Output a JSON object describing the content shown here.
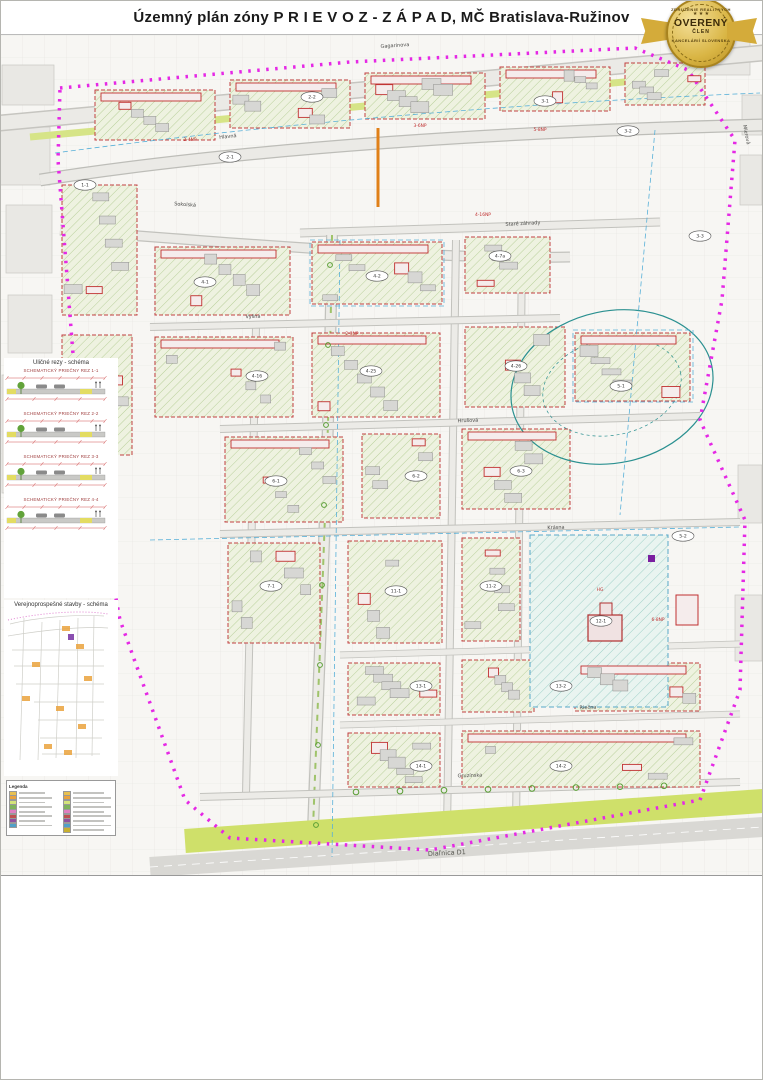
{
  "title": "Územný plán zóny P R I E V O Z - Z Á P A D, MČ Bratislava-Ružinov",
  "badge": {
    "arc_top": "ZDRUŽENIE REALITNÝCH",
    "stars": "★ ★ ★",
    "main": "OVERENÝ",
    "sub": "ČLEN",
    "arc_bottom": "KANCELÁRIÍ SLOVENSKA",
    "gold": "#d9b544"
  },
  "map": {
    "boundary_color": "#e528e5",
    "streets": [
      {
        "label": "Gagarinova",
        "x": 395,
        "y": 12,
        "r": -4
      },
      {
        "label": "Hlavná",
        "x": 228,
        "y": 103,
        "r": -6
      },
      {
        "label": "Mierová",
        "x": 745,
        "y": 100,
        "r": 78
      },
      {
        "label": "Sokolská",
        "x": 185,
        "y": 171,
        "r": 4
      },
      {
        "label": "Staré záhrady",
        "x": 523,
        "y": 190,
        "r": -3
      },
      {
        "label": "Vyšná",
        "x": 253,
        "y": 283,
        "r": -2
      },
      {
        "label": "Hrušová",
        "x": 468,
        "y": 387,
        "r": -2
      },
      {
        "label": "Krásna",
        "x": 556,
        "y": 494,
        "r": -2
      },
      {
        "label": "Riečna",
        "x": 588,
        "y": 674,
        "r": -2
      },
      {
        "label": "Gruzínska",
        "x": 470,
        "y": 742,
        "r": -2
      }
    ],
    "highway_label": {
      "label": "Diaľnica D1",
      "x": 447,
      "y": 820,
      "r": -3
    },
    "ovals": [
      {
        "c": "1-1",
        "x": 85,
        "y": 150
      },
      {
        "c": "2-1",
        "x": 230,
        "y": 122
      },
      {
        "c": "2-2",
        "x": 312,
        "y": 62
      },
      {
        "c": "3-1",
        "x": 545,
        "y": 66
      },
      {
        "c": "3-2",
        "x": 628,
        "y": 96
      },
      {
        "c": "4-1",
        "x": 205,
        "y": 247
      },
      {
        "c": "4-2",
        "x": 377,
        "y": 241
      },
      {
        "c": "4-7a",
        "x": 500,
        "y": 221
      },
      {
        "c": "4-16",
        "x": 257,
        "y": 341
      },
      {
        "c": "4-25",
        "x": 371,
        "y": 336
      },
      {
        "c": "4-26",
        "x": 516,
        "y": 331
      },
      {
        "c": "5-1",
        "x": 621,
        "y": 351
      },
      {
        "c": "6-1",
        "x": 276,
        "y": 446
      },
      {
        "c": "6-2",
        "x": 416,
        "y": 441
      },
      {
        "c": "6-3",
        "x": 521,
        "y": 436
      },
      {
        "c": "7-1",
        "x": 271,
        "y": 551
      },
      {
        "c": "11-1",
        "x": 396,
        "y": 556
      },
      {
        "c": "11-2",
        "x": 491,
        "y": 551
      },
      {
        "c": "12-1",
        "x": 601,
        "y": 586
      },
      {
        "c": "13-1",
        "x": 421,
        "y": 651
      },
      {
        "c": "13-2",
        "x": 561,
        "y": 651
      },
      {
        "c": "14-1",
        "x": 421,
        "y": 731
      },
      {
        "c": "14-2",
        "x": 561,
        "y": 731
      },
      {
        "c": "5-2",
        "x": 683,
        "y": 501
      },
      {
        "c": "3-3",
        "x": 700,
        "y": 201
      }
    ],
    "bldg_labels": [
      {
        "t": "2-4NP",
        "x": 190,
        "y": 106
      },
      {
        "t": "3-6NP",
        "x": 420,
        "y": 92
      },
      {
        "t": "4-16NP",
        "x": 483,
        "y": 181
      },
      {
        "t": "5-8NP",
        "x": 540,
        "y": 96
      },
      {
        "t": "2-3NP",
        "x": 352,
        "y": 300
      },
      {
        "t": "HG",
        "x": 600,
        "y": 556
      },
      {
        "t": "6-8NP",
        "x": 658,
        "y": 586
      }
    ]
  },
  "left_panel": {
    "sections_title": "Uličné rezy - schéma",
    "sections": [
      "SCHEMATICKÝ PRIEČNY REZ 1-1",
      "SCHEMATICKÝ PRIEČNY REZ 2-2",
      "SCHEMATICKÝ PRIEČNY REZ 3-3",
      "SCHEMATICKÝ PRIEČNY REZ 4-4"
    ],
    "vps_title": "Verejnoprospešné stavby - schéma",
    "mini_legend_title": "Legenda",
    "mini_legend_chips": [
      "#e8c050",
      "#eaa23c",
      "#d4e47a",
      "#7fb35c",
      "#e07fc0",
      "#c05050",
      "#9050a0",
      "#50a0c8",
      "#e8c050",
      "#eaa23c",
      "#d4e47a",
      "#7fb35c",
      "#e07fc0",
      "#c05050",
      "#9050a0",
      "#50a0c8",
      "#c8b030"
    ]
  },
  "legend": {
    "heading": "Legenda:",
    "col1": [
      {
        "type": "boundary",
        "label": "hranica riešeného územia"
      },
      {
        "type": "thin",
        "label": "katastrálna mapa"
      },
      {
        "type": "grayfill",
        "label": "budovy existujúce"
      },
      {
        "type": "redbld",
        "label": "budovy navrhované"
      },
      {
        "type": "grayx",
        "label": "existujúce budovy v nesúlade s ÚPN BA"
      },
      {
        "type": "dashout",
        "label": "obrys podzemných častí budov"
      },
      {
        "type": "fence",
        "label": "oplotenie areálov"
      },
      {
        "type": "kota",
        "label": "výšková kóta m n. m. Bpv",
        "chip_text": "137,6"
      },
      {
        "type": "reddash",
        "label": "podzemné časti hromadných garáží navrhované"
      },
      {
        "type": "bluedash",
        "label": "hranica urbanistického sektora"
      },
      {
        "type": "reddash2",
        "label": "hranica stavebného bloku"
      },
      {
        "type": "rail",
        "label": "železničná trať"
      },
      {
        "type": "hwy",
        "label": "diaľnica D1"
      },
      {
        "type": "roadex",
        "label": "miestne cesty existujúce"
      },
      {
        "type": "roadnew",
        "label": "miestne cesty - návrh"
      }
    ],
    "col2_header1": "Ochranné pásma a pamiatková ochrana",
    "col2a": [
      {
        "type": "opdash",
        "label": "OP pohrebiska"
      },
      {
        "type": "opdash2",
        "label": "OP dráhy"
      },
      {
        "type": "opdash3",
        "label": "OP leteckej infraštruktúry"
      },
      {
        "type": "bluetext",
        "chip_text": "150,0",
        "label": "max. povolená výška objektu"
      },
      {
        "type": "greendash",
        "label": "historické parky (NKP)"
      },
      {
        "type": "purplesq",
        "label": "národná kultúrna pamiatka (NKP)"
      },
      {
        "type": "circle",
        "label": "pamätihodnosť MČ"
      }
    ],
    "col2_header2": "Regulácia využitia zastavateľných plôch",
    "col2b": [
      {
        "type": "redline",
        "label": "uličná čiara"
      },
      {
        "type": "darkline",
        "label": "stavebná čiara"
      },
      {
        "type": "pinkdot",
        "label": "aktívny parter"
      },
      {
        "type": "bluedashline",
        "label": "zadná stavebná čiara"
      },
      {
        "type": "bluetext",
        "chip_text": "4NP",
        "label": "maximálna podlažnosť"
      },
      {
        "type": "redtext",
        "chip_text": "x %",
        "label": "parametrický údaj"
      },
      {
        "type": "redtextit",
        "chip_text": "(x %)",
        "label": "parametrický údaj - smerný"
      }
    ],
    "col3_header": "Regulačné tabuľky",
    "col3_groups": [
      {
        "cells": [
          "1-1",
          "980"
        ],
        "labels": [
          "označenie stavebného bloku",
          "funkčné využitie"
        ]
      },
      {
        "cells": [
          "1-1",
          "980",
          "70:30"
        ],
        "labels": [
          "označenie stavebného bloku",
          "funkčné využitie",
          "parametrický pomer OVmin : BTVmax"
        ]
      },
      {
        "cells": [
          "1-1",
          "980",
          "4 NP"
        ],
        "labels": [
          "ozn. stavebného bloku",
          "funkčné využitie",
          "maximálna podlažnosť"
        ]
      },
      {
        "cells": [
          "1-4",
          "980",
          "70:30",
          "2 000",
          "5 800",
          "0,2"
        ],
        "labels": [
          "označenie stavebného bloku",
          "funkčné využitie",
          "parametrický pomer OVmin : BTVmax",
          "maximálna zastavaná plocha ZPmax",
          "maximálna hrubá podl. plocha NPPmax",
          "minimálny koeficient zelene KZmin"
        ]
      }
    ],
    "rd_title": "Regulácia max. zastavanej plochy pre RD",
    "rd_headers": [
      "Veľkosť pozemku (m²)",
      "Max. zastavaná plocha rodinného domu vr. garáže (m²)"
    ],
    "rd_rows": [
      [
        "do 400",
        "120"
      ],
      [
        "401 - 600",
        "150"
      ],
      [
        "601 - 800",
        "180"
      ],
      [
        "nad 800",
        "240"
      ]
    ],
    "col4_header": "Regulácia využitia nezastavateľných plôch",
    "col4_sub": "funkčné využitie",
    "col4": [
      {
        "chip": "#e6e0b0",
        "label": "plochy námestí"
      },
      {
        "chip": "#d8d8d4",
        "label": "verejné priestory s prevahou dopravnej funkcie"
      },
      {
        "chip": "#e0d8c0",
        "label": "verejné priestranstvá s dominanciou pešieho pohybu"
      },
      {
        "chip": "#cfe3b0",
        "label": "vyhradená zeleň areálov"
      },
      {
        "chip": "#bcd98e",
        "label": "zeleň parkov"
      },
      {
        "chip": "#c8e0c8",
        "label": "zeleň cintorínov"
      },
      {
        "chip": "#a8cf88",
        "label": "zeleň verejná"
      },
      {
        "chip": "#dceab8",
        "label": "zeleň záhrad"
      },
      {
        "chip": "#98c070",
        "label": "ochranná a izolačná zeleň"
      },
      {
        "chip": "#ffffff",
        "label": "dosadba uličných stromoradí"
      }
    ],
    "col4_param_cells": [
      "70",
      "30"
    ],
    "col4_param": "parametrický pomer spevnených a nespevnených plôch",
    "col4_note": "Pozn.:"
  },
  "reg_table": {
    "title": "Regulačné zásady vo vybraných stavebných blokoch",
    "headers": [
      "ÚZ profil ÚPN-BA",
      "FV profil ÚPN-BA",
      "označ. stav. bloku",
      "plocha ÚB (m²)",
      "kód funkč. využitia FV",
      "max. podlažnosť NP+ust.",
      "zastav. plocha (m²) ZPmax",
      "hrubá podl. plocha (m²) NPPmax",
      "koeficient zelene KZmin",
      "OVmax %",
      "BTVmax %"
    ],
    "rows": [
      [
        "01/2",
        "201",
        "3",
        "2 561",
        "OV",
        "5+0",
        "510",
        "1 600",
        "0,1",
        "100",
        "0"
      ],
      [
        "01/1",
        "201",
        "1-2a",
        "8 234",
        "OV",
        "8+0",
        "1 800",
        "9 200",
        "0,1",
        "100",
        "0"
      ],
      [
        "01/1",
        "201",
        "1-2b",
        "12 595",
        "OV",
        "5+0",
        "1 050",
        "10 400",
        "0,2",
        "100",
        "0"
      ],
      [
        "01/1",
        "201",
        "1-3*",
        "18 878",
        "OV",
        "11+0",
        "2 800",
        "22 600",
        "0,2",
        "100",
        "0"
      ],
      [
        "01/2",
        "201",
        "1-4",
        "5 828",
        "OV",
        "3+1",
        "2 000",
        "5 800",
        "0,2",
        "100",
        "20"
      ]
    ],
    "footnote": "1-3* - rezervovaná HPP pre realizáciu: min. 1 200 PM a 4 000 m² HPP, 1 200 PM a 6 000 m² HPP"
  },
  "sectors": {
    "title": "Urbanistické sektory a stavebné bloky - schéma",
    "numbers": [
      {
        "n": "1",
        "x": 68,
        "y": 16
      },
      {
        "n": "2",
        "x": 128,
        "y": 128
      },
      {
        "n": "3",
        "x": 152,
        "y": 100
      },
      {
        "n": "4",
        "x": 78,
        "y": 40
      },
      {
        "n": "5",
        "x": 22,
        "y": 33
      },
      {
        "n": "6",
        "x": 103,
        "y": 44
      },
      {
        "n": "7",
        "x": 37,
        "y": 138
      },
      {
        "n": "8",
        "x": 42,
        "y": 62
      },
      {
        "n": "9",
        "x": 50,
        "y": 107
      },
      {
        "n": "10",
        "x": 92,
        "y": 75
      },
      {
        "n": "11",
        "x": 84,
        "y": 133
      },
      {
        "n": "12",
        "x": 138,
        "y": 141
      },
      {
        "n": "13",
        "x": 118,
        "y": 76
      },
      {
        "n": "14",
        "x": 112,
        "y": 133
      },
      {
        "n": "15",
        "x": 127,
        "y": 179
      }
    ],
    "codes": [
      {
        "t": "1-2",
        "x": 58,
        "y": 20
      },
      {
        "t": "4-2",
        "x": 64,
        "y": 60
      },
      {
        "t": "10-2",
        "x": 80,
        "y": 90
      },
      {
        "t": "11-1",
        "x": 72,
        "y": 120
      },
      {
        "t": "13-4",
        "x": 104,
        "y": 92
      },
      {
        "t": "7-2",
        "x": 42,
        "y": 156
      },
      {
        "t": "1-3",
        "x": 98,
        "y": 18
      },
      {
        "t": "12-1",
        "x": 130,
        "y": 158
      }
    ]
  },
  "title_block": {
    "line1": "Územný plán zóny",
    "line2": "Prievoz - západ",
    "line3": "Mestská časť Bratislava-Ružinov",
    "line4": "REGULÁCIA ÚZEMIA",
    "line5": "Návrh riešenia",
    "f1_label": "Obstarávateľ:",
    "f1": "MČ Bratislava-Ružinov",
    "f2_label": "Autor:",
    "f3_label": "Dátum:",
    "f3": "september 2004",
    "f4_label": "Mierka:",
    "f4": "1 : 1000",
    "num_label": "Číslo výkresu:",
    "num": "6"
  }
}
